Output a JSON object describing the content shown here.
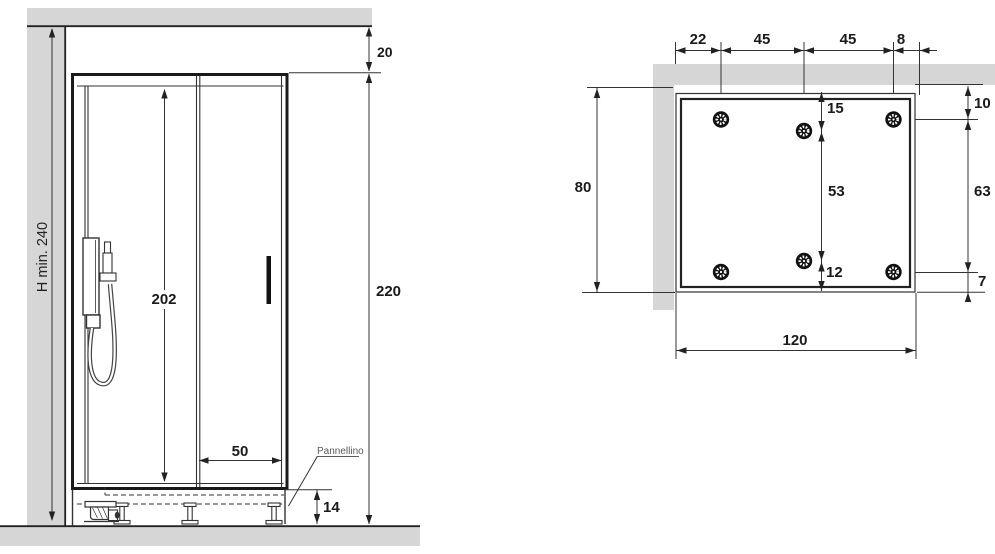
{
  "figure": {
    "type": "technical installation drawing",
    "subject": "shower enclosure front view and tray plan view",
    "units": "cm"
  },
  "front_view": {
    "labels": {
      "h_min": "H min. 240",
      "gap_top": "20",
      "height_total": "220",
      "opening_height": "202",
      "door_width": "50",
      "base_height": "14",
      "panel_note": "Pannellino"
    }
  },
  "top_view": {
    "fixing_points_count": 6,
    "labels": {
      "top_chain": [
        "22",
        "45",
        "45",
        "8"
      ],
      "left_total": "80",
      "inner_chain": [
        "15",
        "53",
        "12"
      ],
      "right_chain": [
        "10",
        "63",
        "7"
      ],
      "bottom_width": "120"
    }
  },
  "colors": {
    "wall_fill": "#d6d6d6",
    "line": "#222222",
    "note_gray": "#5a5a5a"
  }
}
